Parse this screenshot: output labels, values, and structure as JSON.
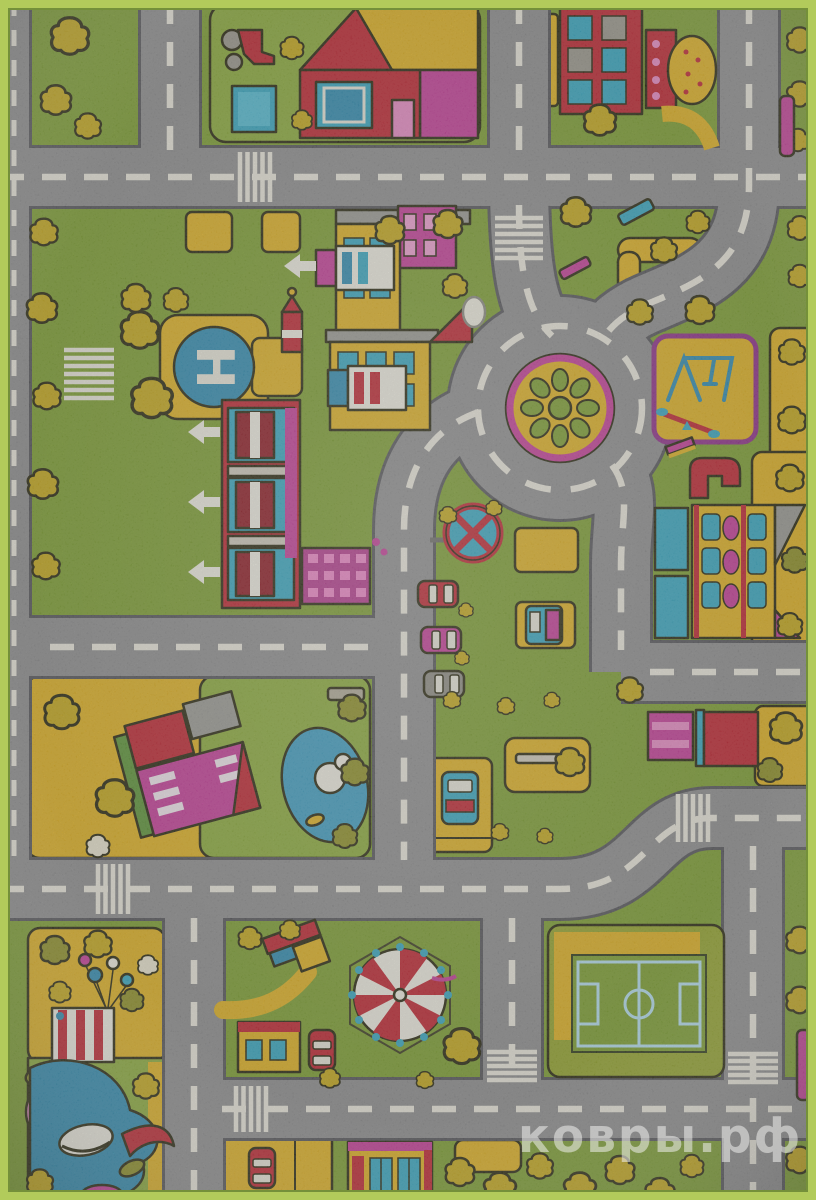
{
  "watermark": {
    "text": "ковры.рф"
  },
  "helipad": {
    "letter": "H"
  },
  "palette": {
    "grass": "#7d9f31",
    "grassLight": "#8cab3c",
    "road": "#8e8e90",
    "roadEdge": "#55555a",
    "roadDash": "#eae7dc",
    "yellow": "#e0b122",
    "tree": "#c6a91c",
    "treeDark": "#8f9026",
    "treeEdge": "#2f2e10",
    "red": "#bf2531",
    "darkRed": "#8e1a24",
    "magenta": "#c43d98",
    "pink": "#e98cc6",
    "purple": "#8e2f8a",
    "blue": "#2f8cb1",
    "teal": "#37a7c2",
    "lightBlue": "#b5dff0",
    "white": "#efede2",
    "outline": "#27260f",
    "edge": "#b2cb5b",
    "gray": "#9b988e",
    "watermark": "#f0f0ee"
  },
  "scene": {
    "kind": "children-road-play-rug-photo",
    "elements": [
      "house-with-pool",
      "tractor",
      "school-building",
      "food-kiosk",
      "helipad",
      "fire-station",
      "city-buildings",
      "clock-tower",
      "roundabout-flower-island",
      "playground",
      "no-parking-sign",
      "parked-cars",
      "parking-lots",
      "pond-farm",
      "duck",
      "carnival-stall",
      "balloons",
      "circus-tent",
      "elephant-slide",
      "soccer-field",
      "trees",
      "roads-with-crosswalks"
    ]
  }
}
